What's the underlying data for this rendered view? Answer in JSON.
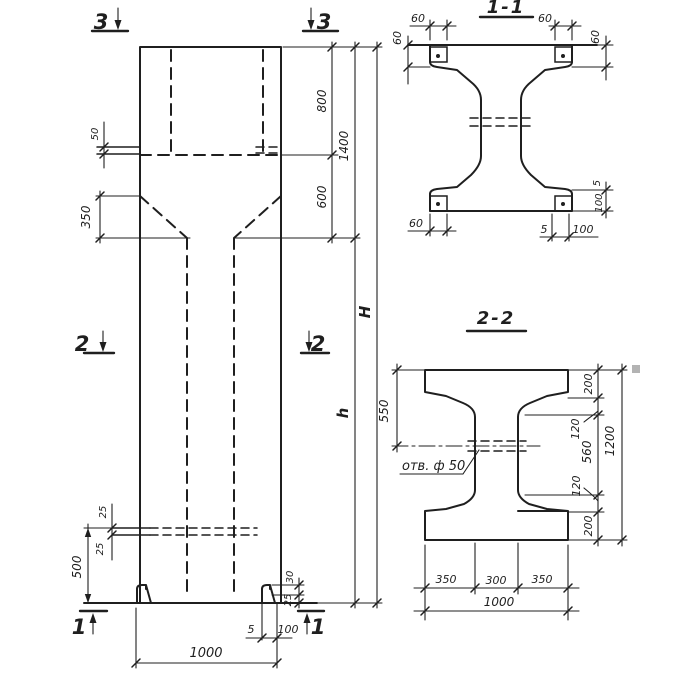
{
  "colors": {
    "ink": "#1f1f1f",
    "paper": "#ffffff",
    "artifact": "#b3b3b3"
  },
  "elevation": {
    "marks": {
      "top_left": "3",
      "top_right": "3",
      "mid_left": "2",
      "mid_right": "2",
      "bottom_left": "1",
      "bottom_right": "1"
    },
    "dims": {
      "cap_plate": "50",
      "taper_height": "350",
      "cap_top": "800",
      "cap_total": "1400",
      "neck": "600",
      "total_height": "H",
      "shaft_height": "h",
      "console_upper": "25",
      "console_lower": "25",
      "base_height": "500",
      "foot_upper": "30",
      "foot_lower": "25",
      "foot_plate_thickness": "5",
      "foot_plate_width": "100",
      "column_width": "1000"
    }
  },
  "section_1_1": {
    "title": "1-1",
    "dims": {
      "top_left_60": "60",
      "left_60": "60",
      "top_right_60": "60",
      "right_60": "60",
      "bottom_left_60": "60",
      "bottom_5": "5",
      "bottom_100": "100",
      "side_5": "5",
      "side_100": "100"
    }
  },
  "section_2_2": {
    "title": "2-2",
    "hole_label": "отв. ф 50",
    "dims": {
      "flange_550": "550",
      "top_200": "200",
      "upper_120": "120",
      "web_560": "560",
      "lower_120": "120",
      "bottom_200": "200",
      "height_1200": "1200",
      "bottom_350_left": "350",
      "bottom_300": "300",
      "bottom_350_right": "350",
      "bottom_1000": "1000"
    }
  }
}
